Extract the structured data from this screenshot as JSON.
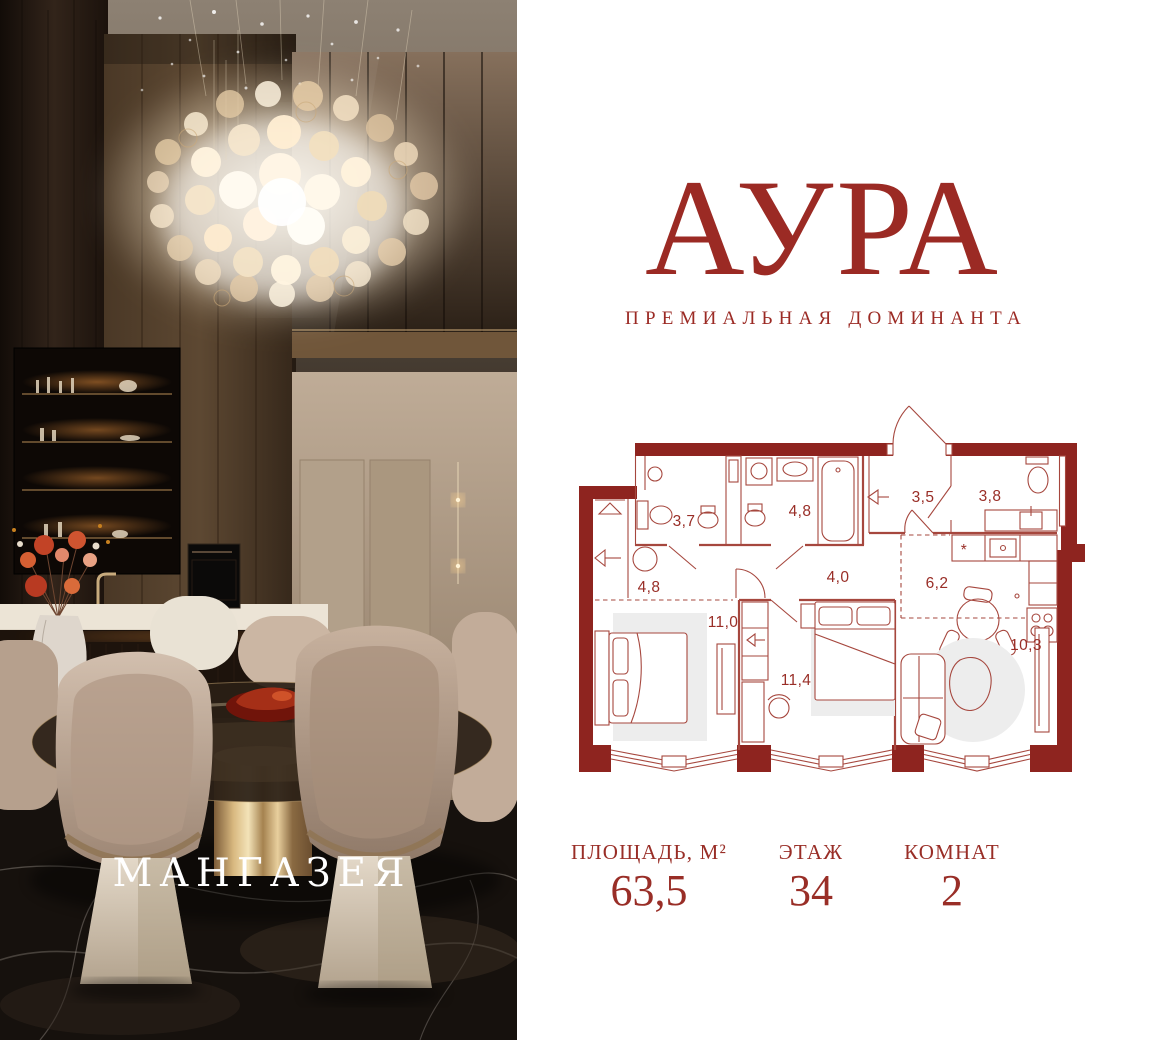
{
  "brand": {
    "developer_overlay": "МАНГАЗЕЯ"
  },
  "header": {
    "title": "АУРА",
    "subtitle": "ПРЕМИАЛЬНАЯ ДОМИНАНТА"
  },
  "colors": {
    "accent": "#9b2a24",
    "plan_wall": "#8e241f",
    "plan_line": "#a6473e",
    "plan_label": "#992e27",
    "rug": "#ededed",
    "overlay_text": "#ffffff",
    "page_background": "#ffffff"
  },
  "floor_plan": {
    "rooms": [
      {
        "id": "bathroom-1",
        "area": "3,7"
      },
      {
        "id": "bathroom-2",
        "area": "4,8"
      },
      {
        "id": "entry-hall",
        "area": "3,5"
      },
      {
        "id": "bathroom-3",
        "area": "3,8"
      },
      {
        "id": "hallway",
        "area": "4,8"
      },
      {
        "id": "corridor",
        "area": "4,0"
      },
      {
        "id": "kitchen",
        "area": "6,2"
      },
      {
        "id": "bedroom-1",
        "area": "11,0"
      },
      {
        "id": "bedroom-2",
        "area": "11,4"
      },
      {
        "id": "living-room",
        "area": "10,3"
      }
    ],
    "kitchen_symbol": "*"
  },
  "stats": [
    {
      "label": "ПЛОЩАДЬ, М²",
      "value": "63,5"
    },
    {
      "label": "ЭТАЖ",
      "value": "34"
    },
    {
      "label": "КОМНАТ",
      "value": "2"
    }
  ]
}
